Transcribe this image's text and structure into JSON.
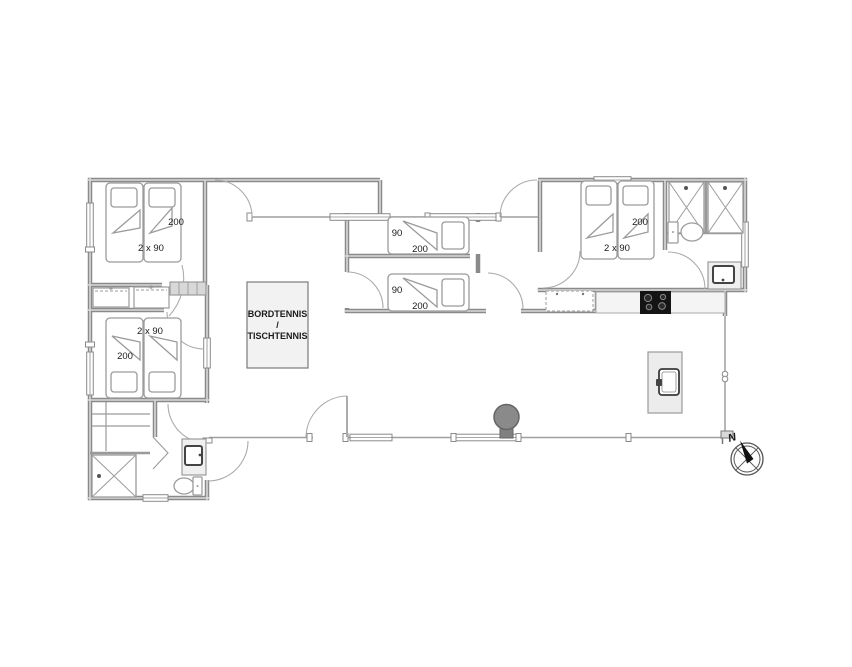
{
  "floorplan": {
    "bedroom_top_left": {
      "bed_width": "2 x 90",
      "bed_length": "200"
    },
    "bedroom_mid_left": {
      "bed_width": "2 x 90",
      "bed_length": "200"
    },
    "bedroom_right": {
      "bed_width": "2 x 90",
      "bed_length": "200"
    },
    "small_room_upper": {
      "bed_width": "90",
      "bed_length": "200"
    },
    "small_room_lower": {
      "bed_width": "90",
      "bed_length": "200"
    },
    "activity_room": {
      "label_line1": "BORDTENNIS",
      "label_line2": "/",
      "label_line3": "TISCHTENNIS"
    },
    "compass": {
      "north": "N"
    },
    "colors": {
      "wall": "#8a8a8a",
      "wall_core": "#d9d9d9",
      "glass": "#9f9f9f",
      "furniture_line": "#9b9b9b",
      "cooktop": "#141414",
      "stove": "#8a8a8a",
      "table_fill": "#f2f2f2",
      "counter_fill": "#f4f4f4",
      "text": "#1a1a1a"
    }
  }
}
